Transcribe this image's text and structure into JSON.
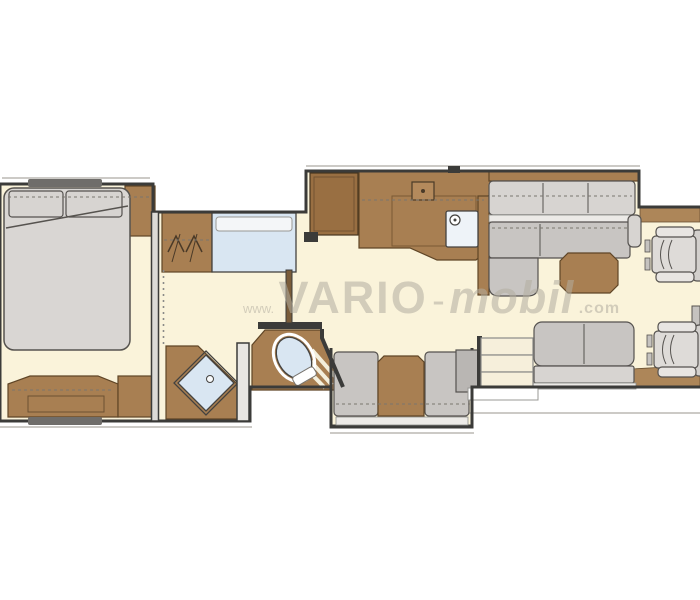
{
  "page": {
    "background": "#ffffff"
  },
  "watermark": {
    "www": "www.",
    "brand": "VARIO",
    "sep": "-",
    "brand_suffix": "mobil",
    "tld": ".com",
    "full_text": "www.VARIO-mobil.com",
    "color": "#b3aea0"
  },
  "palette": {
    "floor": "#faf3da",
    "wall": "#3b3b39",
    "wood": "#a87f52",
    "wood_dark": "#996f42",
    "wood_floor": "#ad8659",
    "upholstery": "#c8c5c2",
    "upholstery_light": "#d7d4d1",
    "fixture_blue": "#d9e6f2",
    "outline": "#55524f",
    "outside": "#ffffff"
  },
  "floorplan": {
    "type": "motorhome-floor-plan",
    "rooms": [
      {
        "name": "bedroom",
        "items": [
          "double-bed",
          "pillow-left",
          "pillow-right",
          "headboard-cabinet",
          "dresser"
        ]
      },
      {
        "name": "bathroom",
        "items": [
          "wardrobe",
          "washbasin",
          "shower",
          "shower-drain",
          "toilet"
        ]
      },
      {
        "name": "kitchen",
        "items": [
          "tall-cabinet",
          "kitchen-counter",
          "hob",
          "sink",
          "faucet"
        ]
      },
      {
        "name": "lounge",
        "items": [
          "l-sofa",
          "coffee-table",
          "dinette-bench-left",
          "dinette-table",
          "dinette-bench-right",
          "two-seater-sofa"
        ]
      },
      {
        "name": "entrance",
        "items": [
          "entry-steps",
          "entry-platform",
          "side-cabinet"
        ]
      },
      {
        "name": "cab",
        "items": [
          "cab-seat-front",
          "cab-seat-rear",
          "center-console"
        ]
      }
    ]
  }
}
